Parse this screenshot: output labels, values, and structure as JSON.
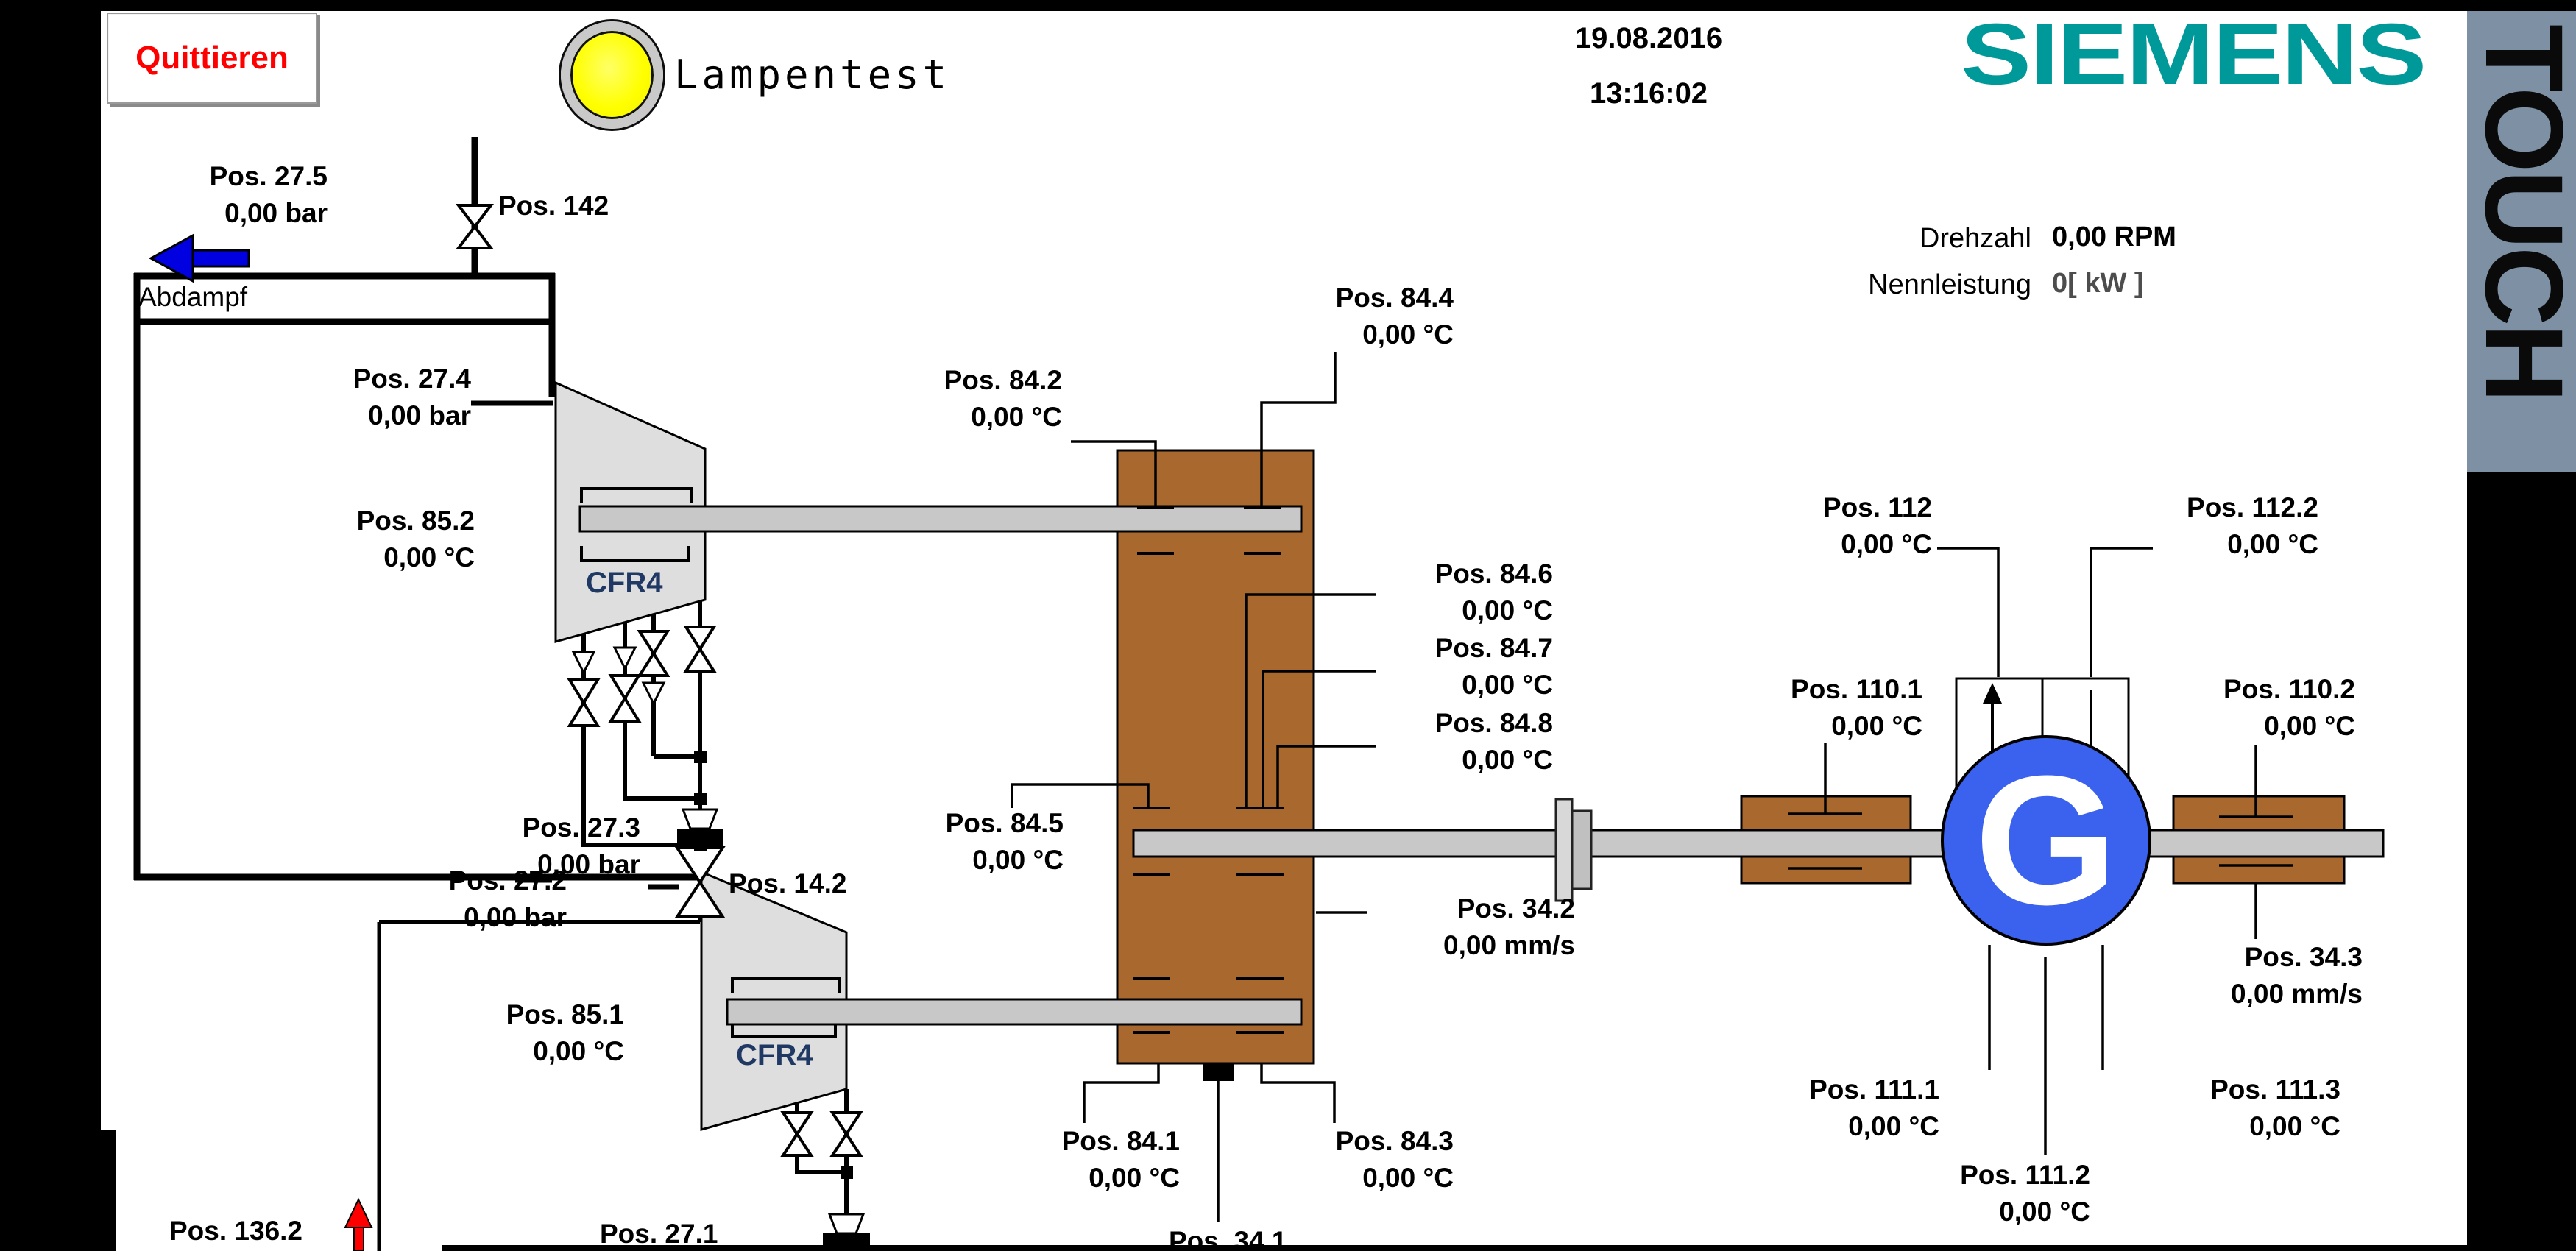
{
  "frame": {
    "touch_label": "TOUCH"
  },
  "header": {
    "quittieren": "Quittieren",
    "lampentest": "Lampentest",
    "date": "19.08.2016",
    "time": "13:16:02",
    "brand": "SIEMENS"
  },
  "readouts": {
    "drehzahl_label": "Drehzahl",
    "drehzahl_value": "0,00 RPM",
    "nennleistung_label": "Nennleistung",
    "nennleistung_value": "0[ kW ]"
  },
  "diagram": {
    "abdampf": "Abdampf",
    "cfr4_upper": "CFR4",
    "cfr4_lower": "CFR4",
    "generator_letter": "G",
    "points": {
      "p27_5": {
        "name": "Pos. 27.5",
        "value": "0,00 bar"
      },
      "p142": {
        "name": "Pos. 142"
      },
      "p27_4": {
        "name": "Pos. 27.4",
        "value": "0,00 bar"
      },
      "p85_2": {
        "name": "Pos. 85.2",
        "value": "0,00 °C"
      },
      "p27_3": {
        "name": "Pos. 27.3",
        "value": "0,00 bar"
      },
      "p14_2": {
        "name": "Pos. 14.2"
      },
      "p27_2": {
        "name": "Pos. 27.2",
        "value": "0,00 bar"
      },
      "p85_1": {
        "name": "Pos. 85.1",
        "value": "0,00 °C"
      },
      "p27_1": {
        "name": "Pos. 27.1"
      },
      "p136_2": {
        "name": "Pos. 136.2"
      },
      "p84_2": {
        "name": "Pos. 84.2",
        "value": "0,00 °C"
      },
      "p84_4": {
        "name": "Pos. 84.4",
        "value": "0,00 °C"
      },
      "p84_5": {
        "name": "Pos. 84.5",
        "value": "0,00 °C"
      },
      "p84_6": {
        "name": "Pos. 84.6",
        "value": "0,00 °C"
      },
      "p84_7": {
        "name": "Pos. 84.7",
        "value": "0,00 °C"
      },
      "p84_8": {
        "name": "Pos. 84.8",
        "value": "0,00 °C"
      },
      "p84_1": {
        "name": "Pos. 84.1",
        "value": "0,00 °C"
      },
      "p84_3": {
        "name": "Pos. 84.3",
        "value": "0,00 °C"
      },
      "p34_2": {
        "name": "Pos. 34.2",
        "value": "0,00 mm/s"
      },
      "p34_1": {
        "name": "Pos. 34.1"
      },
      "p34_3": {
        "name": "Pos. 34.3",
        "value": "0,00 mm/s"
      },
      "p112": {
        "name": "Pos. 112",
        "value": "0,00 °C"
      },
      "p112_2": {
        "name": "Pos. 112.2",
        "value": "0,00 °C"
      },
      "p110_1": {
        "name": "Pos. 110.1",
        "value": "0,00 °C"
      },
      "p110_2": {
        "name": "Pos. 110.2",
        "value": "0,00 °C"
      },
      "p111_1": {
        "name": "Pos. 111.1",
        "value": "0,00 °C"
      },
      "p111_2": {
        "name": "Pos. 111.2",
        "value": "0,00 °C"
      },
      "p111_3": {
        "name": "Pos. 111.3",
        "value": "0,00 °C"
      }
    }
  },
  "colors": {
    "accent_red": "#FF0000",
    "siemens_teal": "#009999",
    "lamp_yellow": "#FFFF00",
    "gearbox_brown": "#A9692E",
    "generator_blue": "#3A62EE",
    "touch_bar_gray": "#7D90A4",
    "flow_arrow_blue": "#0000E0",
    "cfr4_navy": "#203864"
  }
}
